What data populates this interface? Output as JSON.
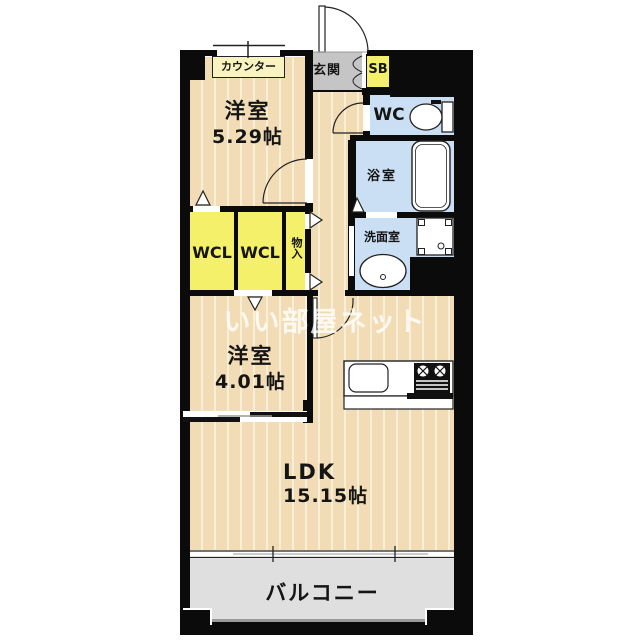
{
  "watermark": "いい部屋ネット",
  "colors": {
    "wall": "#0b0b0b",
    "floor": "#f2dcb5",
    "floorStripe": "#f9eed7",
    "yellow": "#f4f06a",
    "paleYellow": "#f9f3c2",
    "blue": "#cadff4",
    "entranceGray": "#c5c5c5",
    "balconyGray": "#dfdfdf"
  },
  "rooms": {
    "western1": {
      "label": "洋室",
      "size": "5.29帖"
    },
    "western2": {
      "label": "洋室",
      "size": "4.01帖"
    },
    "ldk": {
      "label": "LDK",
      "size": "15.15帖"
    },
    "balcony": {
      "label": "バルコニー"
    },
    "entrance": {
      "label": "玄関"
    },
    "shoebox": {
      "label": "SB"
    },
    "toilet": {
      "label": "WC"
    },
    "bath": {
      "label": "浴室"
    },
    "washroom": {
      "label": "洗面室"
    },
    "wcl1": {
      "label": "WCL"
    },
    "wcl2": {
      "label": "WCL"
    },
    "storage": {
      "label": "物入"
    },
    "counter": {
      "label": "カウンター"
    }
  }
}
